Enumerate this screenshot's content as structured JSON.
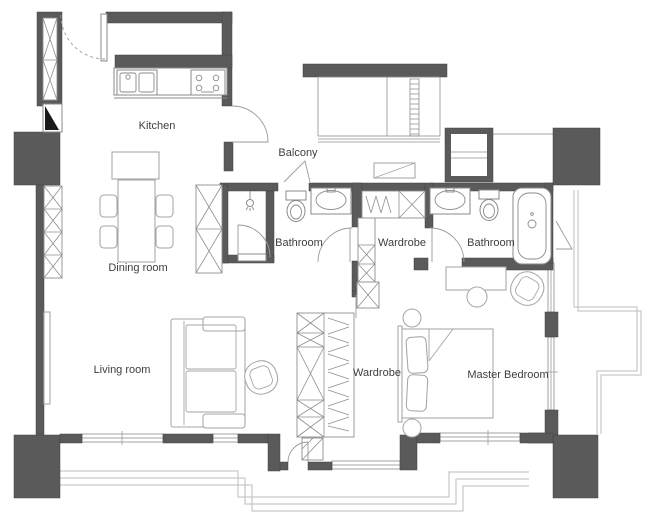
{
  "plan": {
    "rooms": [
      {
        "id": "kitchen",
        "label": "Kitchen"
      },
      {
        "id": "balcony",
        "label": "Balcony"
      },
      {
        "id": "dining-room",
        "label": "Dining room"
      },
      {
        "id": "bathroom-1",
        "label": "Bathroom"
      },
      {
        "id": "wardrobe-1",
        "label": "Wardrobe"
      },
      {
        "id": "bathroom-2",
        "label": "Bathroom"
      },
      {
        "id": "living-room",
        "label": "Living room"
      },
      {
        "id": "wardrobe-2",
        "label": "Wardrobe"
      },
      {
        "id": "master-bedroom",
        "label": "Master Bedroom"
      }
    ],
    "colors": {
      "wall": "#5a5a5a",
      "furniture_line": "#a6a6a6",
      "fixture_line": "#8a8a8a",
      "terrace_line": "#bdbdbd",
      "text": "#3e3e3e",
      "background": "#ffffff"
    }
  }
}
